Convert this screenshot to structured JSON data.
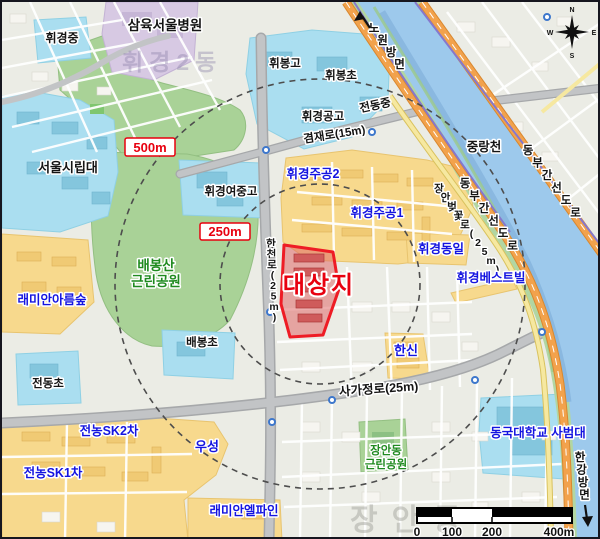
{
  "figure": {
    "type": "site-location-map"
  },
  "site": {
    "label": "대상지"
  },
  "radius": {
    "r500": "500m",
    "r250": "250m"
  },
  "places": {
    "samyook_seoul_hospital": "삼육서울병원",
    "hwigyeong_middle": "휘경중",
    "seoul_city_university": "서울시립대",
    "hwibong_high": "휘봉고",
    "hwibong_elementary": "휘봉초",
    "jeondong_middle": "전동중",
    "hwigyeong_technical_high": "휘경공고",
    "hwigyeong_girls_middle_high": "휘경여중고",
    "baebong_elementary": "배봉초",
    "jeondong_elementary": "전동초",
    "jungnangcheon": "중랑천",
    "hwigyeong_jugong2": "휘경주공2",
    "hwigyeong_jugong1": "휘경주공1",
    "hwigyeong_dongil": "휘경동일",
    "hwigyeong_bestvill": "휘경베스트빌",
    "hanshin": "한신",
    "raemian_areumsup": "래미안아름숲",
    "jeonnong_sk2": "전농SK2차",
    "jeonnong_sk1": "전농SK1차",
    "wooseong": "우성",
    "raemian_elpine": "래미안엘파인",
    "dongguk_univ_college_of_education": "동국대학교 사범대"
  },
  "parks": {
    "baebongsan": {
      "line1": "배봉산",
      "line2": "근린공원"
    },
    "jangandong": {
      "line1": "장안동",
      "line2": "근린공원"
    }
  },
  "roads": {
    "gyeomjae_ro": "겸재로(15m)",
    "hancheon_ro": "한천로(25m)",
    "sagajeong_ro": "사가정로(25m)",
    "jangan_beotkkot_ro": "장안벚꽃로(25m)",
    "dongbu_expressway_upper": "동부간선도로",
    "dongbu_expressway_lower": "동부간선도로"
  },
  "directions": {
    "nowon": "노원방면",
    "hangang": "한강방면"
  },
  "compass": {
    "n": "N",
    "e": "E",
    "s": "S",
    "w": "W"
  },
  "scale_bar": {
    "tick_0": "0",
    "tick_100": "100",
    "tick_200": "200",
    "tick_400": "400m"
  },
  "watermarks": {
    "district_top": "휘경2동",
    "district_bottom": "장안동"
  },
  "colors": {
    "site_outline": "#ee1c25",
    "site_fill": "#e06a6a",
    "radius_label_red": "#e8000f",
    "school_cyan": "#aadef0",
    "apartment_yellow": "#f7d98d",
    "park_green": "#a9d297",
    "hospital_purple": "#d7c9e3",
    "river_blue": "#9dc9ec",
    "expressway_orange": "#f2a24c",
    "label_blue": "#1414e0",
    "label_green": "#1f8a1f",
    "road_gray": "#b7b9bb"
  }
}
